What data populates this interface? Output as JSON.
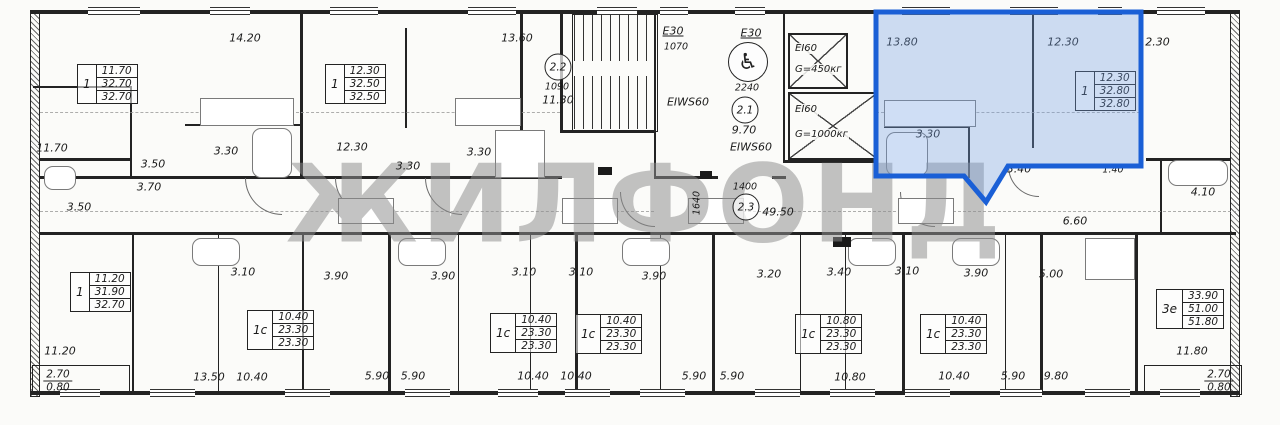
{
  "watermark": {
    "text": "ЖИЛФОНД"
  },
  "highlight_color": "#1a5fd6",
  "icons": {
    "wheelchair": "♿"
  },
  "circles": [
    {
      "t": "2.2",
      "x": 558,
      "y": 67
    },
    {
      "t": "2.1",
      "x": 745,
      "y": 110
    },
    {
      "t": "2.3",
      "x": 746,
      "y": 207
    }
  ],
  "labels": [
    {
      "t": "14.20",
      "x": 245,
      "y": 38,
      "n": "room-area-label"
    },
    {
      "t": "13.60",
      "x": 517,
      "y": 38,
      "n": "room-area-label"
    },
    {
      "t": "1090",
      "x": 557,
      "y": 87,
      "s": 1
    },
    {
      "t": "11.30",
      "x": 558,
      "y": 100,
      "n": "room-area-label"
    },
    {
      "t": "E30",
      "x": 673,
      "y": 31,
      "u": 1,
      "n": "door-rating-label"
    },
    {
      "t": "1070",
      "x": 676,
      "y": 47,
      "s": 1
    },
    {
      "t": "E30",
      "x": 751,
      "y": 33,
      "u": 1,
      "n": "door-rating-label"
    },
    {
      "t": "2240",
      "x": 747,
      "y": 88,
      "s": 1
    },
    {
      "t": "9.70",
      "x": 744,
      "y": 130,
      "n": "room-area-label"
    },
    {
      "t": "EIWS60",
      "x": 688,
      "y": 102,
      "n": "door-rating-label"
    },
    {
      "t": "EIWS60",
      "x": 751,
      "y": 147,
      "n": "door-rating-label"
    },
    {
      "t": "13.80",
      "x": 902,
      "y": 42,
      "n": "room-area-label"
    },
    {
      "t": "12.30",
      "x": 1063,
      "y": 42,
      "n": "room-area-label"
    },
    {
      "t": "12.30",
      "x": 1154,
      "y": 42,
      "n": "room-area-label"
    },
    {
      "t": "3.30",
      "x": 928,
      "y": 134
    },
    {
      "t": "3.40",
      "x": 1019,
      "y": 169
    },
    {
      "t": "1.40",
      "x": 1113,
      "y": 170,
      "s": 1
    },
    {
      "t": "4.10",
      "x": 1203,
      "y": 192,
      "n": "room-area-label"
    },
    {
      "t": "6.60",
      "x": 1075,
      "y": 221,
      "n": "room-area-label"
    },
    {
      "t": "11.70",
      "x": 52,
      "y": 148,
      "n": "room-area-label"
    },
    {
      "t": "3.50",
      "x": 153,
      "y": 164
    },
    {
      "t": "3.70",
      "x": 149,
      "y": 187
    },
    {
      "t": "3.30",
      "x": 226,
      "y": 151
    },
    {
      "t": "12.30",
      "x": 352,
      "y": 147,
      "n": "room-area-label"
    },
    {
      "t": "3.30",
      "x": 408,
      "y": 166
    },
    {
      "t": "3.30",
      "x": 479,
      "y": 152
    },
    {
      "t": "3.50",
      "x": 79,
      "y": 207
    },
    {
      "t": "1400",
      "x": 745,
      "y": 187,
      "s": 1
    },
    {
      "t": "1640",
      "x": 697,
      "y": 203,
      "r": 1,
      "s": 1
    },
    {
      "t": "49.50",
      "x": 778,
      "y": 212,
      "n": "room-area-label"
    },
    {
      "t": "3.10",
      "x": 243,
      "y": 272
    },
    {
      "t": "3.90",
      "x": 336,
      "y": 276
    },
    {
      "t": "3.90",
      "x": 443,
      "y": 276
    },
    {
      "t": "3.10",
      "x": 524,
      "y": 272
    },
    {
      "t": "3.10",
      "x": 581,
      "y": 272
    },
    {
      "t": "3.90",
      "x": 654,
      "y": 276
    },
    {
      "t": "3.20",
      "x": 769,
      "y": 274
    },
    {
      "t": "3.40",
      "x": 839,
      "y": 272
    },
    {
      "t": "3.10",
      "x": 907,
      "y": 271
    },
    {
      "t": "3.90",
      "x": 976,
      "y": 273
    },
    {
      "t": "5.00",
      "x": 1051,
      "y": 274,
      "n": "room-area-label"
    },
    {
      "t": "11.20",
      "x": 60,
      "y": 351,
      "n": "room-area-label"
    },
    {
      "t": "11.80",
      "x": 1192,
      "y": 351,
      "n": "room-area-label"
    },
    {
      "t": "13.50",
      "x": 209,
      "y": 377
    },
    {
      "t": "10.40",
      "x": 252,
      "y": 377
    },
    {
      "t": "5.90",
      "x": 377,
      "y": 376
    },
    {
      "t": "5.90",
      "x": 413,
      "y": 376
    },
    {
      "t": "10.40",
      "x": 533,
      "y": 376
    },
    {
      "t": "10.40",
      "x": 576,
      "y": 376
    },
    {
      "t": "5.90",
      "x": 694,
      "y": 376
    },
    {
      "t": "5.90",
      "x": 732,
      "y": 376
    },
    {
      "t": "10.80",
      "x": 850,
      "y": 377
    },
    {
      "t": "10.40",
      "x": 954,
      "y": 376
    },
    {
      "t": "5.90",
      "x": 1013,
      "y": 376
    },
    {
      "t": "9.80",
      "x": 1056,
      "y": 376
    }
  ],
  "unit_boxes": [
    {
      "type": "1",
      "rows": [
        "11.70",
        "32.70",
        "32.70"
      ],
      "x": 77,
      "y": 64,
      "sel": false
    },
    {
      "type": "1",
      "rows": [
        "12.30",
        "32.50",
        "32.50"
      ],
      "x": 325,
      "y": 64,
      "sel": false
    },
    {
      "type": "1",
      "rows": [
        "12.30",
        "32.80",
        "32.80"
      ],
      "x": 1075,
      "y": 71,
      "sel": true
    },
    {
      "type": "1",
      "rows": [
        "11.20",
        "31.90",
        "32.70"
      ],
      "x": 70,
      "y": 272,
      "sel": false
    },
    {
      "type": "1с",
      "rows": [
        "10.40",
        "23.30",
        "23.30"
      ],
      "x": 247,
      "y": 310,
      "sel": false
    },
    {
      "type": "1с",
      "rows": [
        "10.40",
        "23.30",
        "23.30"
      ],
      "x": 490,
      "y": 313,
      "sel": false
    },
    {
      "type": "1с",
      "rows": [
        "10.40",
        "23.30",
        "23.30"
      ],
      "x": 575,
      "y": 314,
      "sel": false
    },
    {
      "type": "1с",
      "rows": [
        "10.80",
        "23.30",
        "23.30"
      ],
      "x": 795,
      "y": 314,
      "sel": false
    },
    {
      "type": "1с",
      "rows": [
        "10.40",
        "23.30",
        "23.30"
      ],
      "x": 920,
      "y": 314,
      "sel": false
    },
    {
      "type": "3е",
      "rows": [
        "33.90",
        "51.00",
        "51.80"
      ],
      "x": 1156,
      "y": 289,
      "sel": false
    }
  ],
  "elevators": [
    {
      "name": "EI60",
      "cap": "G=450кг",
      "x": 788,
      "y": 33,
      "w": 56,
      "h": 52
    },
    {
      "name": "EI60",
      "cap": "G=1000кг",
      "x": 788,
      "y": 92,
      "w": 86,
      "h": 64
    }
  ],
  "balconies": [
    {
      "top": "2.70",
      "bot": "0.80",
      "x": 58,
      "y": 381
    },
    {
      "top": "2.70",
      "bot": "0.80",
      "x": 1219,
      "y": 381
    }
  ]
}
